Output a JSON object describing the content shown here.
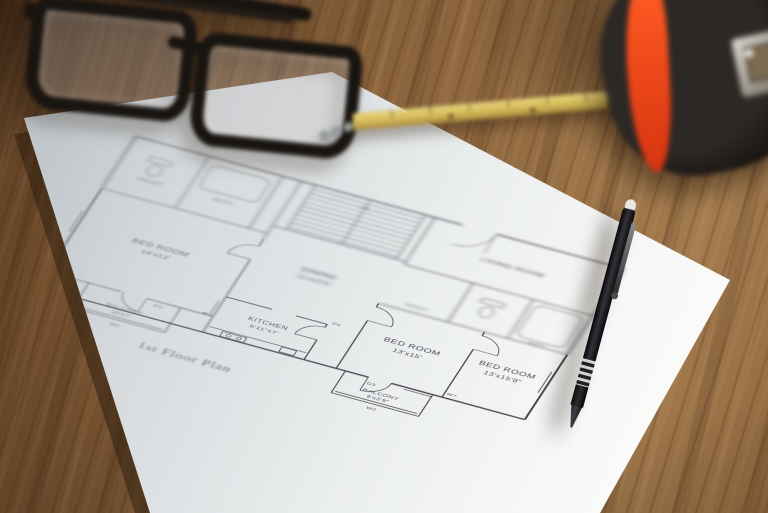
{
  "floor_plan": {
    "title": "1st Floor Plan",
    "rooms": [
      {
        "name": "BED ROOM",
        "size": "14'x13'"
      },
      {
        "name": "DINING",
        "size": "11'x12'6\""
      },
      {
        "name": "KITCHEN",
        "size": "6'11\"x7'"
      },
      {
        "name": "BED ROOM",
        "size": "13'x15'"
      },
      {
        "name": "BED ROOM",
        "size": "13'x15'8\""
      },
      {
        "name": "BALCONY",
        "size": "10'x7'"
      },
      {
        "name": "BALCONY",
        "size": "9'x3'9\""
      },
      {
        "name": "TOILET",
        "size": ""
      },
      {
        "name": "BATH",
        "size": ""
      },
      {
        "name": "LIVING ROOM",
        "size": ""
      },
      {
        "name": "TOILET",
        "size": ""
      },
      {
        "name": "BATH",
        "size": ""
      }
    ],
    "markers": [
      "D2",
      "D3",
      "D3",
      "W2",
      "W2",
      "W3",
      "W7"
    ]
  },
  "objects": {
    "glasses": "folded black eyeglasses",
    "ruler": "yellow ruler",
    "tape_measure": "tape measure",
    "pen": "black mechanical pencil"
  },
  "colors": {
    "wood": "#86603a",
    "paper": "#eef1f2",
    "ink": "#4a4a52",
    "ruler_yellow": "#d4ba58",
    "tape_orange": "#e84a1e",
    "pen_black": "#141216"
  }
}
